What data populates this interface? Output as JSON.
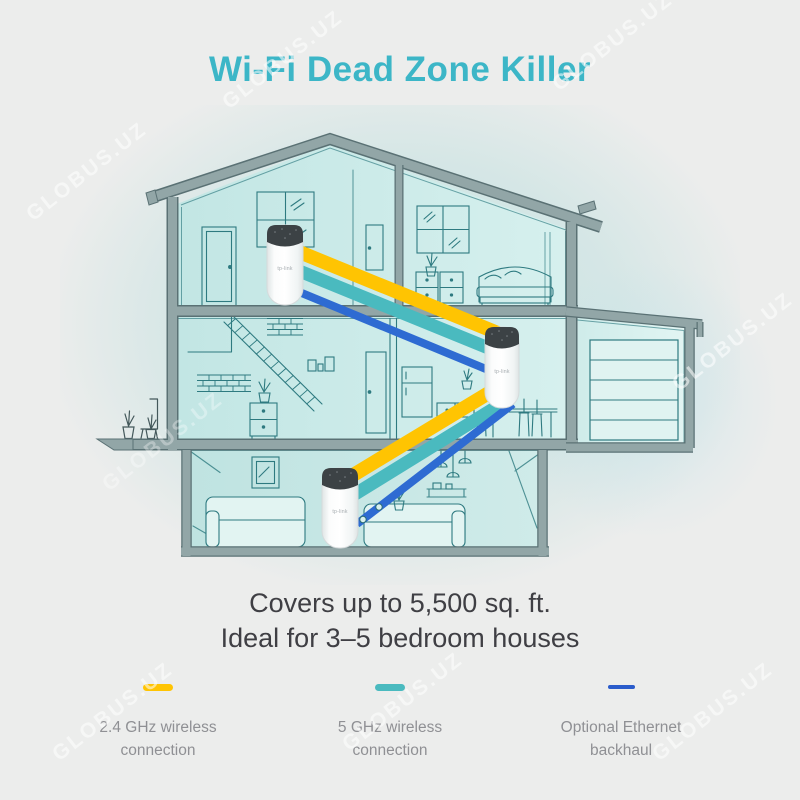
{
  "header": {
    "title": "Wi-Fi Dead Zone Killer"
  },
  "caption": {
    "line1": "Covers up to 5,500 sq. ft.",
    "line2": "Ideal for 3–5 bedroom houses"
  },
  "legend": {
    "items": [
      {
        "line1": "2.4 GHz wireless",
        "line2": "connection",
        "color": "#FFC402",
        "style": "thick-dash"
      },
      {
        "line1": "5 GHz wireless",
        "line2": "connection",
        "color": "#4ABABF",
        "style": "thick-dash"
      },
      {
        "line1": "Optional Ethernet",
        "line2": "backhaul",
        "color": "#2A5CCB",
        "style": "thin-dash"
      }
    ]
  },
  "devices": {
    "logo_label": "tp-link",
    "unit_count": 3
  },
  "watermark": {
    "text": "GLOBUS.UZ"
  },
  "colors": {
    "background": "#ECEDEC",
    "brand_teal_title": "#3CB6C7",
    "band_2_4ghz_yellow": "#FFC402",
    "band_5ghz_teal": "#4ABABF",
    "band_ethernet_blue": "#2E6BD2",
    "house_outline_teal": "#2E7A80",
    "structure_gray": "#92A6A7",
    "caption_text": "#3F3F44",
    "legend_text": "#8F9094"
  }
}
